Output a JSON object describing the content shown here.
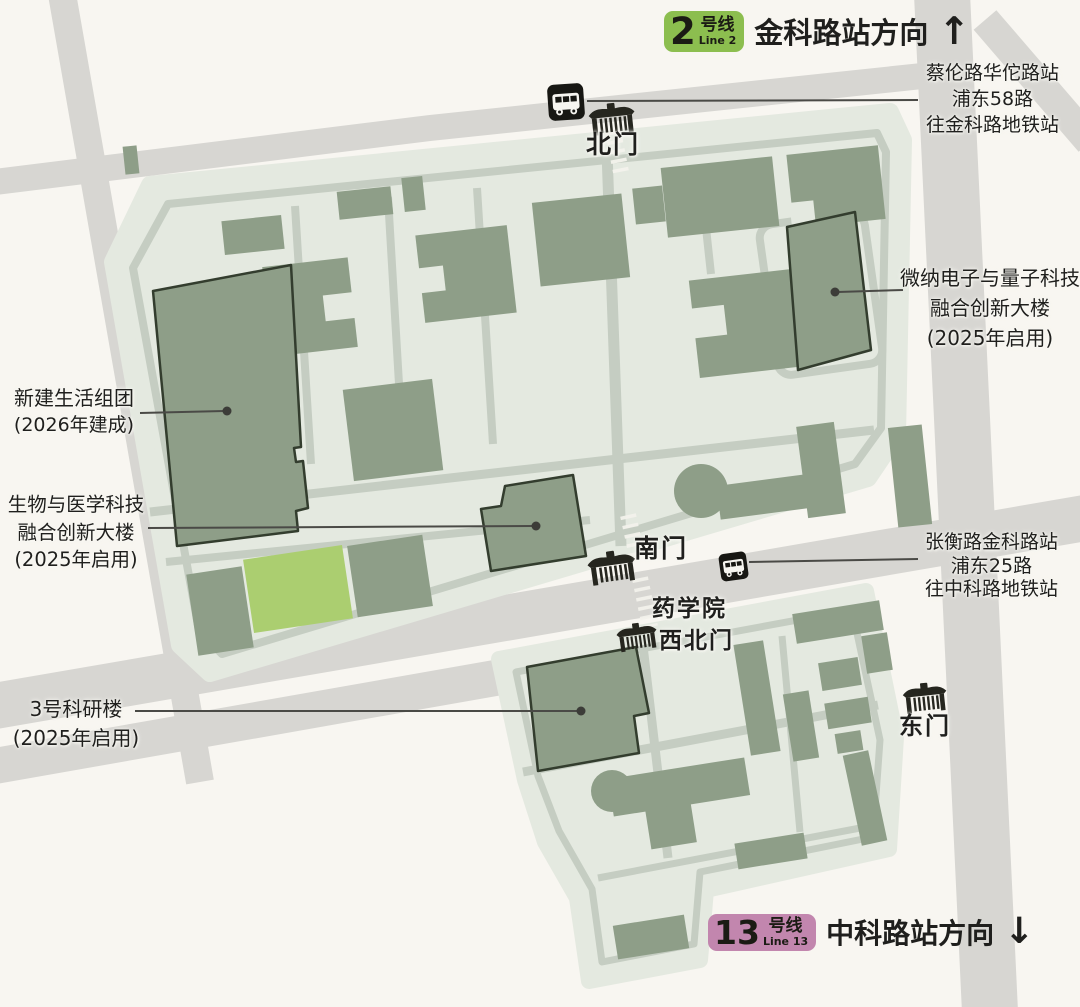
{
  "header": {
    "badge": {
      "number": "2",
      "suffix": "号线",
      "sub": "Line 2"
    },
    "direction": "金科路站方向",
    "arrow": "↑"
  },
  "footer": {
    "badge": {
      "number": "13",
      "suffix": "号线",
      "sub": "Line 13"
    },
    "direction": "中科路站方向",
    "arrow": "↓"
  },
  "bus_stops": {
    "north": {
      "line1": "蔡伦路华佗路站",
      "line2": "浦东58路",
      "line3": "往金科路地铁站"
    },
    "south": {
      "line1": "张衡路金科路站",
      "line2": "浦东25路",
      "line3": "往中科路地铁站"
    }
  },
  "gates": {
    "north": "北门",
    "south": "南门",
    "pharmacy_line1": "药学院",
    "pharmacy_line2": "西北门",
    "east": "东门"
  },
  "labels": {
    "residential": {
      "line1": "新建生活组团",
      "line2": "(2026年建成)"
    },
    "biomed": {
      "line1": "生物与医学科技",
      "line2": "融合创新大楼",
      "line3": "(2025年启用)"
    },
    "micro": {
      "line1": "微纳电子与量子科技",
      "line2": "融合创新大楼",
      "line3": "(2025年启用)"
    },
    "lab3": {
      "line1": "3号科研楼",
      "line2": "(2025年启用)"
    }
  },
  "colors": {
    "background": "#F8F6F1",
    "road": "#D7D6D2",
    "campus": "#E4E9E0",
    "path": "#C5CDC2",
    "building": "#8E9E88",
    "building_outline": "#333D2E",
    "highlight_building": "#ABCE70",
    "line2_badge": "#8CBE4F",
    "line13_badge": "#C286AE",
    "icon_dark": "#26261f",
    "text": "#1F1F1D"
  }
}
